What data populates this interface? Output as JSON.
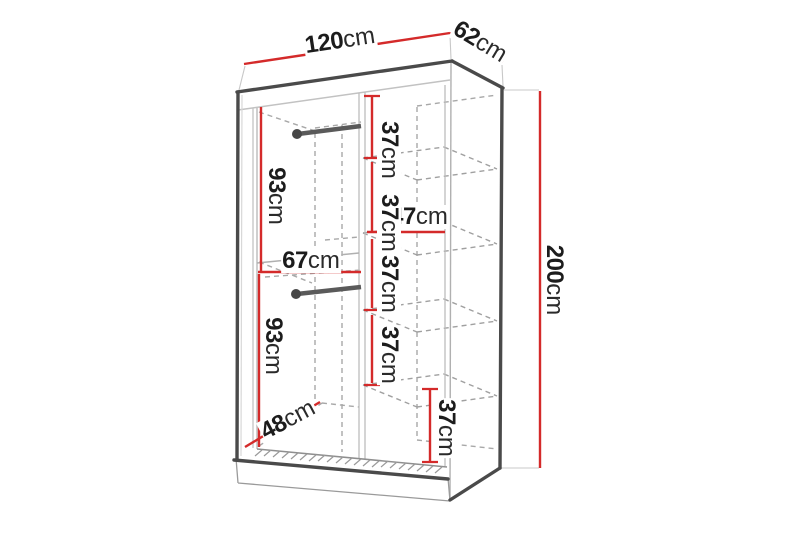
{
  "diagram": {
    "title": "wardrobe-dimension-diagram",
    "unit": "cm",
    "accent_color": "#d42a2a",
    "line_color": "#4a4a4a",
    "dims": {
      "width": {
        "num": "120",
        "unit": "cm"
      },
      "depth": {
        "num": "62",
        "unit": "cm"
      },
      "height": {
        "num": "200",
        "unit": "cm"
      },
      "hang_top": {
        "num": "93",
        "unit": "cm"
      },
      "hang_bottom": {
        "num": "93",
        "unit": "cm"
      },
      "left_width": {
        "num": "67",
        "unit": "cm"
      },
      "right_width": {
        "num": "47",
        "unit": "cm"
      },
      "floor_depth": {
        "num": "48",
        "unit": "cm"
      },
      "shelf": {
        "num": "37",
        "unit": "cm"
      },
      "shelf_label_count": 5
    }
  }
}
